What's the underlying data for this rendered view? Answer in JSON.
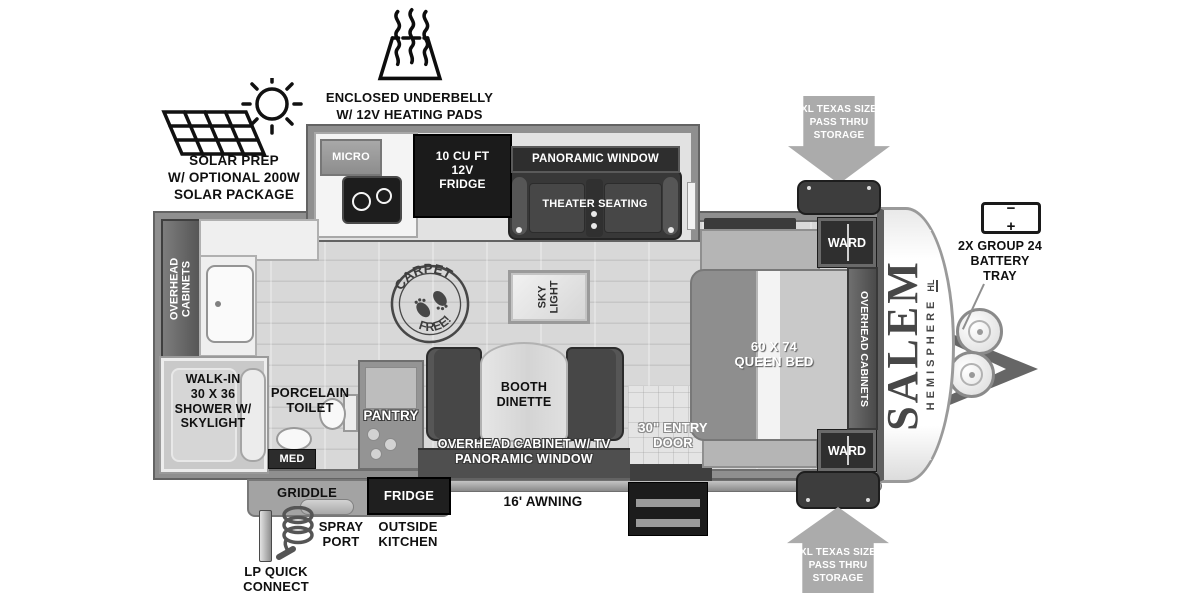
{
  "brand": {
    "name": "SALEM",
    "sub": "HEMISPHERE",
    "trim": "HL"
  },
  "callouts": {
    "underbelly": "ENCLOSED UNDERBELLY\nW/ 12V HEATING PADS",
    "solar": "SOLAR PREP\nW/ OPTIONAL 200W\nSOLAR PACKAGE",
    "pass_thru_top": "XL TEXAS SIZE\nPASS THRU\nSTORAGE",
    "pass_thru_bottom": "XL TEXAS SIZE\nPASS THRU\nSTORAGE",
    "battery": "2X GROUP 24\nBATTERY\nTRAY",
    "battery_terminals": "−  +",
    "awning": "16' AWNING",
    "spray_port": "SPRAY\nPORT",
    "outside_kitchen": "OUTSIDE\nKITCHEN",
    "lp_quick_connect": "LP QUICK\nCONNECT",
    "entry_door": "30\" ENTRY\nDOOR"
  },
  "kitchen": {
    "micro": "MICRO",
    "fridge": "10 CU FT\n12V\nFRIDGE"
  },
  "living": {
    "panoramic_window": "PANORAMIC WINDOW",
    "theater_seating": "THEATER SEATING",
    "skylight": "SKY\nLIGHT",
    "carpet_stamp_top": "CARPET",
    "carpet_stamp_bottom": "FREE!",
    "pantry": "PANTRY",
    "dinette": "BOOTH\nDINETTE",
    "dinette_wall": "OVERHEAD CABINET W/ TV\nPANORAMIC WINDOW"
  },
  "bathroom": {
    "overhead_cabinets": "OVERHEAD\nCABINETS",
    "shower": "WALK-IN\n30 X 36\nSHOWER W/\nSKYLIGHT",
    "toilet": "PORCELAIN\nTOILET",
    "med": "MED"
  },
  "bedroom": {
    "bed": "60 X 74\nQUEEN BED",
    "ward_top": "WARD",
    "ward_bottom": "WARD",
    "overhead_cabinets": "OVERHEAD CABINETS"
  },
  "outside": {
    "griddle": "GRIDDLE",
    "fridge": "FRIDGE"
  },
  "colors": {
    "wall_gray": "#8f8f8f",
    "dark_fixture": "#2e2e2e",
    "arrow_gray": "#ababab",
    "floor_gray": "#d8d8d8",
    "label_black": "#101010",
    "label_white": "#ffffff"
  }
}
